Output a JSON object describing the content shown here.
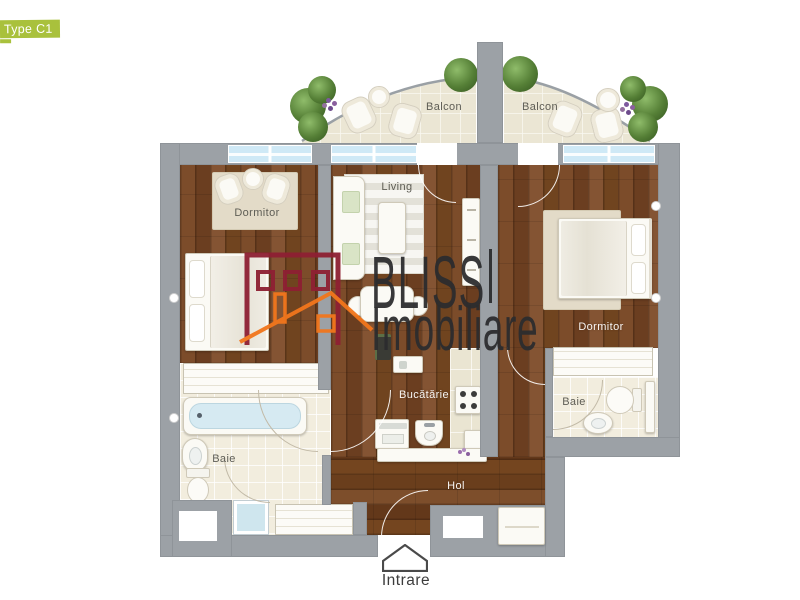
{
  "badge": {
    "type": "Type C1",
    "area_label": "Suprafata construita: 84",
    "area_unit": "sqm"
  },
  "logo": {
    "brand": "BLISS",
    "brand2": "Imobiliare"
  },
  "rooms": {
    "balcon_left": "Balcon",
    "balcon_right": "Balcon",
    "dormitor_left": "Dormitor",
    "living": "Living",
    "dormitor_right": "Dormitor",
    "bucatarie": "Bucătărie",
    "baie_left": "Baie",
    "baie_right": "Baie",
    "hol": "Hol"
  },
  "entrance_label": "Intrare",
  "colors": {
    "accent_green": "#a9c13c",
    "wall_gray": "#9ca1a6",
    "brand_red": "#8e2033",
    "brand_orange": "#f2761c",
    "window_blue": "#cfe9f6"
  }
}
